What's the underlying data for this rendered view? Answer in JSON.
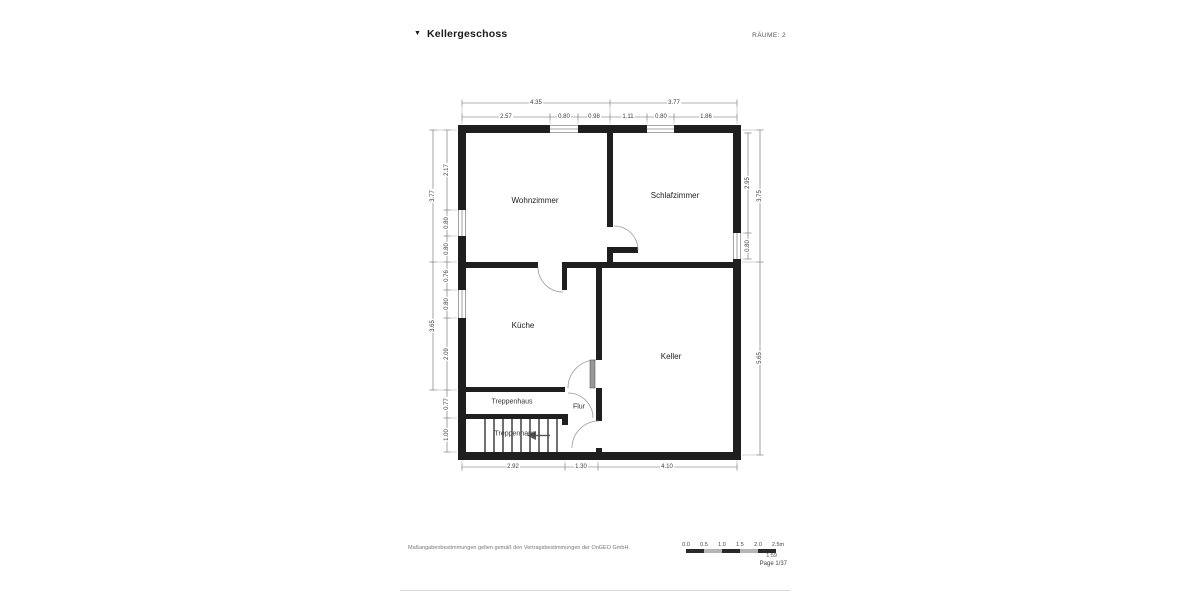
{
  "header": {
    "title": "Kellergeschoss",
    "rooms_label": "RÄUME: 2"
  },
  "rooms": {
    "wohnzimmer": "Wohnzimmer",
    "schlafzimmer": "Schlafzimmer",
    "kueche": "Küche",
    "keller": "Keller",
    "treppenhaus": "Treppenhaus",
    "treppenhaus_stairs": "Treppenhaus",
    "flur": "Flur"
  },
  "dims": {
    "top_outer": [
      "4.35",
      "3.77"
    ],
    "top_inner": [
      "2.57",
      "0.80",
      "0.98",
      "1.11",
      "0.80",
      "1.86"
    ],
    "left_outer": [
      "3.77",
      "3.65"
    ],
    "left_inner": [
      "2.17",
      "0.80",
      "0.80",
      "0.76",
      "0.80",
      "2.09",
      "0.77",
      "1.00"
    ],
    "right_outer": [
      "3.75",
      "5.65"
    ],
    "right_inner": [
      "2.95",
      "0.80"
    ],
    "bottom": [
      "2.92",
      "1.30",
      "4.10"
    ]
  },
  "footer": {
    "disclaimer": "Maßangabenbestimmungen gelten gemäß den Vertragsbestimmungen der OnGEO GmbH.",
    "scale_ticks": [
      "0.0",
      "0.5",
      "1.0",
      "1.5",
      "2.0",
      "2.5m"
    ],
    "scale_ratio": "1:59",
    "page": "Page 1/37"
  },
  "colors": {
    "wall": "#1f1f1f",
    "dim_line": "#666666",
    "door_arc": "#9a9a9a",
    "scale_dark": "#2a2a2a",
    "scale_light": "#b5b5b5"
  }
}
